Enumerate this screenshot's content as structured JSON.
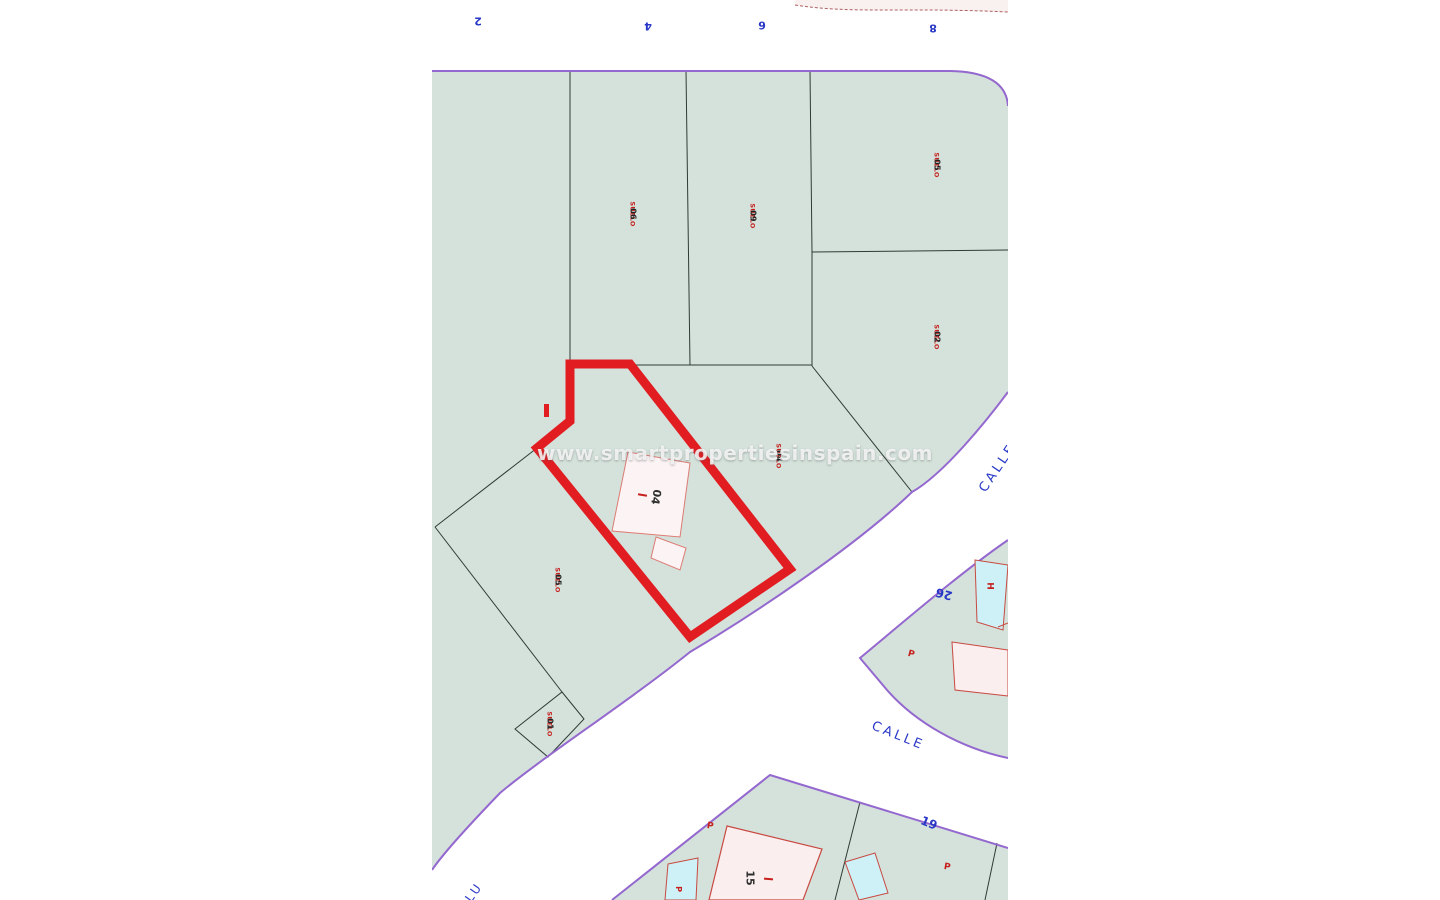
{
  "map": {
    "watermark": "www.smartpropertiesinspain.com",
    "street_name_bottom": "CALLE",
    "street_name_right": "CALLE",
    "street_name_left_partial": "LU",
    "top_street_numbers": [
      {
        "text": "2"
      },
      {
        "text": "4"
      },
      {
        "text": "6"
      },
      {
        "text": "8"
      }
    ],
    "parcel_labels": [
      {
        "suelo": "SUELO",
        "number": "06"
      },
      {
        "suelo": "SUELO",
        "number": "09"
      },
      {
        "suelo": "SUELO",
        "number": "05"
      },
      {
        "suelo": "SUELO",
        "number": "02"
      },
      {
        "suelo": "SUELO",
        "number": "04"
      },
      {
        "suelo": "SUELO",
        "number": "05"
      },
      {
        "suelo": "SUELO",
        "number": "01"
      }
    ],
    "house_numbers": {
      "plot_building": "04",
      "n26": "26",
      "n19": "19",
      "n15": "15"
    },
    "building_letters": {
      "pool_h": "H",
      "p_right": "P",
      "p_bottom_left": "P",
      "p_bottom_right": "P",
      "p_pool_small": "P"
    },
    "colors": {
      "parcel_fill": "#d4e2db",
      "boundary_purple": "#9468cf",
      "parcel_line": "#2f3b35",
      "highlight_plot_red": "#e21d22",
      "building_fill_pink": "#fbeeee",
      "building_fill_white": "#fcf4f4",
      "building_outline_red": "#c84a42",
      "pool_fill_cyan": "#cdf1f6",
      "label_red": "#c6201d",
      "label_blue": "#2837c6",
      "street_white": "#ffffff"
    }
  }
}
